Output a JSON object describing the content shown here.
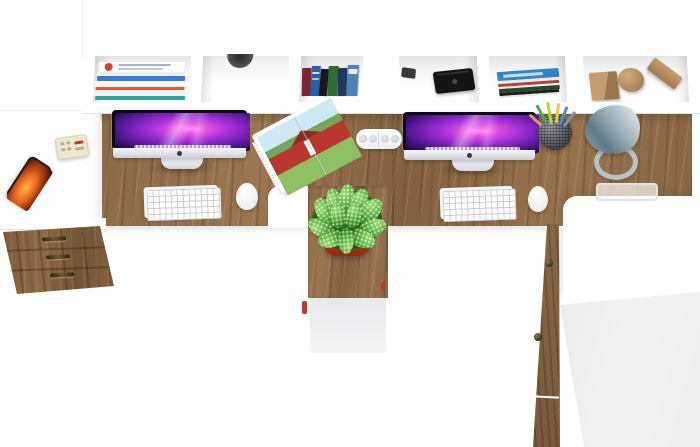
{
  "meta": {
    "type": "product-photo",
    "subject": "Top-down view of a white and oak two-person office workstation",
    "canvas": {
      "width": 700,
      "height": 447
    }
  },
  "palette": {
    "background": "#ffffff",
    "shelf_white": "#ffffff",
    "desk_wood": "#8d6a47",
    "drawer_wood": "#7e5c3c",
    "cabinet_gray_face": "#eef0f1",
    "screen_nebula_purple": "#a32fd8",
    "plant_green": "#4aa52e",
    "pot_terracotta": "#c03a22",
    "lamp_gray_blue": "#8da3ab",
    "phone_screen_orange": "#e2661f",
    "barn_red": "#b8372f"
  },
  "objects": {
    "top_shelf": {
      "label": "white wall shelf with open compartments",
      "compartments": [
        {
          "label": "stack of magazines",
          "layer_colors": [
            "#ffffff",
            "#f0f0f0",
            "#3a7bd5",
            "#ffffff",
            "#e8562a",
            "#f5f5f5",
            "#2aa8a0"
          ]
        },
        {
          "label": "white drawer front with finger hole"
        },
        {
          "label": "row of standing books",
          "spine_colors": [
            "#7b2633",
            "#2b5ea8",
            "#17171c",
            "#2f6b35",
            "#20375f",
            "#4f83b5"
          ]
        },
        {
          "label": "black media device",
          "color": "#141416"
        },
        {
          "label": "stack of books with blue cover",
          "layer_colors": [
            "#2f86c4",
            "#e9e9e9",
            "#c23b2f",
            "#f2f2f2",
            "#274a26",
            "#1d1d1d",
            "#e5e5e5"
          ]
        },
        {
          "label": "wooden decor shapes: cube, disc, block",
          "color": "#c59c6d"
        }
      ]
    },
    "left_side_table": {
      "label": "white side table",
      "items": [
        {
          "label": "smartphone with orange screen"
        },
        {
          "label": "small beige gadget with buttons"
        }
      ]
    },
    "left_workstation": {
      "label": "oak desk top, left seat",
      "items": [
        {
          "label": "all-in-one monitor with purple nebula wallpaper and dock"
        },
        {
          "label": "white keyboard"
        },
        {
          "label": "white mouse"
        },
        {
          "label": "open magazine with red barn farm photo"
        }
      ]
    },
    "center": {
      "label": "shared oak pedestal between desks",
      "items": [
        {
          "label": "green speckled plant in terracotta pot"
        },
        {
          "label": "white 4-socket cable grommet power strip"
        }
      ]
    },
    "right_workstation": {
      "label": "oak desk top, right seat",
      "items": [
        {
          "label": "all-in-one monitor with purple nebula wallpaper and dock"
        },
        {
          "label": "white keyboard"
        },
        {
          "label": "white mouse"
        },
        {
          "label": "metal mesh pen cup with pens and pencils",
          "pen_colors": [
            "#3fae4c",
            "#b9d435",
            "#e8c93e",
            "#4a90d9",
            "#8a8f94",
            "#c9a06a"
          ]
        },
        {
          "label": "gray cone desk lamp on ring base"
        },
        {
          "label": "white document tray"
        }
      ]
    },
    "left_drawer_unit": {
      "label": "three-drawer oak cabinet",
      "drawer_count": 3
    },
    "right_cabinet": {
      "label": "white cabinet with oak door edge",
      "knob_count": 2
    }
  }
}
